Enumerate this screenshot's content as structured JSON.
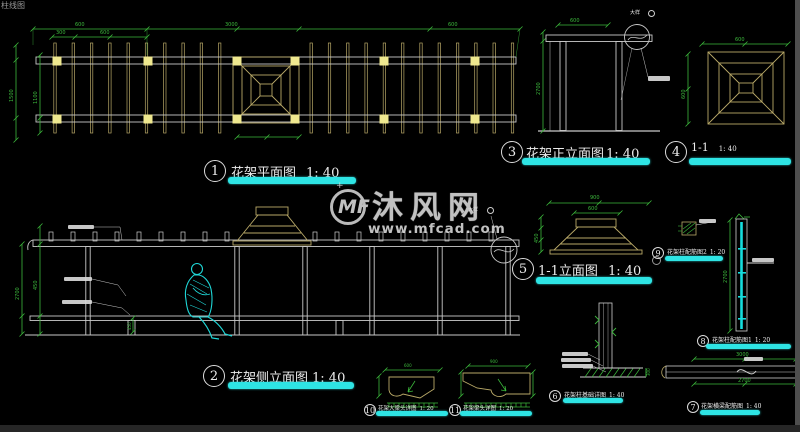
{
  "page": {
    "corner_text": "柱线图"
  },
  "watermark": {
    "logo_text": "MF",
    "star": "+",
    "brand": "沐风网",
    "url": "www.mfcad.com"
  },
  "labels": {
    "l1": {
      "num": "1",
      "title": "花架平面图",
      "scale": "1: 40"
    },
    "l2": {
      "num": "2",
      "title": "花架侧立面图",
      "scale": "1: 40"
    },
    "l3": {
      "num": "3",
      "title": "花架正立面图",
      "scale": "1: 40"
    },
    "l4": {
      "num": "4",
      "title": "1-1",
      "scale": "1: 40"
    },
    "l5": {
      "num": "5",
      "title": "1-1立面图",
      "scale": "1: 40"
    },
    "l6": {
      "num": "6",
      "title": "花架柱基础详图",
      "scale": "1: 40"
    },
    "l7": {
      "num": "7",
      "title": "花架横梁配筋图",
      "scale": "1: 40"
    },
    "l8": {
      "num": "8",
      "title": "花架柱配筋图1",
      "scale": "1: 20"
    },
    "l9": {
      "num": "9",
      "title": "花架柱配筋图2",
      "scale": "1: 20"
    },
    "l10": {
      "num": "10",
      "title": "花架大梁头详图",
      "scale": "1: 20"
    },
    "l11": {
      "num": "11",
      "title": "花架梁头详图",
      "scale": "1: 20"
    }
  },
  "annotations": {
    "w_ref_top": "大样",
    "w_ref_side": "大样"
  },
  "dims": {
    "pd1": "600",
    "pd2": "3000",
    "pd3": "600",
    "pd4": "300",
    "pd5": "600",
    "pl1": "1500",
    "pl2": "1100",
    "e3t": "600",
    "e3l": "2700",
    "d4t": "600",
    "d4l": "600",
    "d5t": "900",
    "d5t2": "600",
    "d5l": "450",
    "sl1": "2700",
    "sl2": "450",
    "sb": "450",
    "c8": "2700",
    "d7t": "3000",
    "d7b": "2700",
    "d6r": "300",
    "d10t": "600",
    "d11t": "900"
  },
  "colors": {
    "accent_cyan": "#2ee4e4",
    "dim_green": "#3cb83c",
    "wood_tan": "#b9a968",
    "line_gray": "#c9c9c9",
    "column_yellow": "#efe88f",
    "figure_cyan": "#1fd8d8"
  }
}
